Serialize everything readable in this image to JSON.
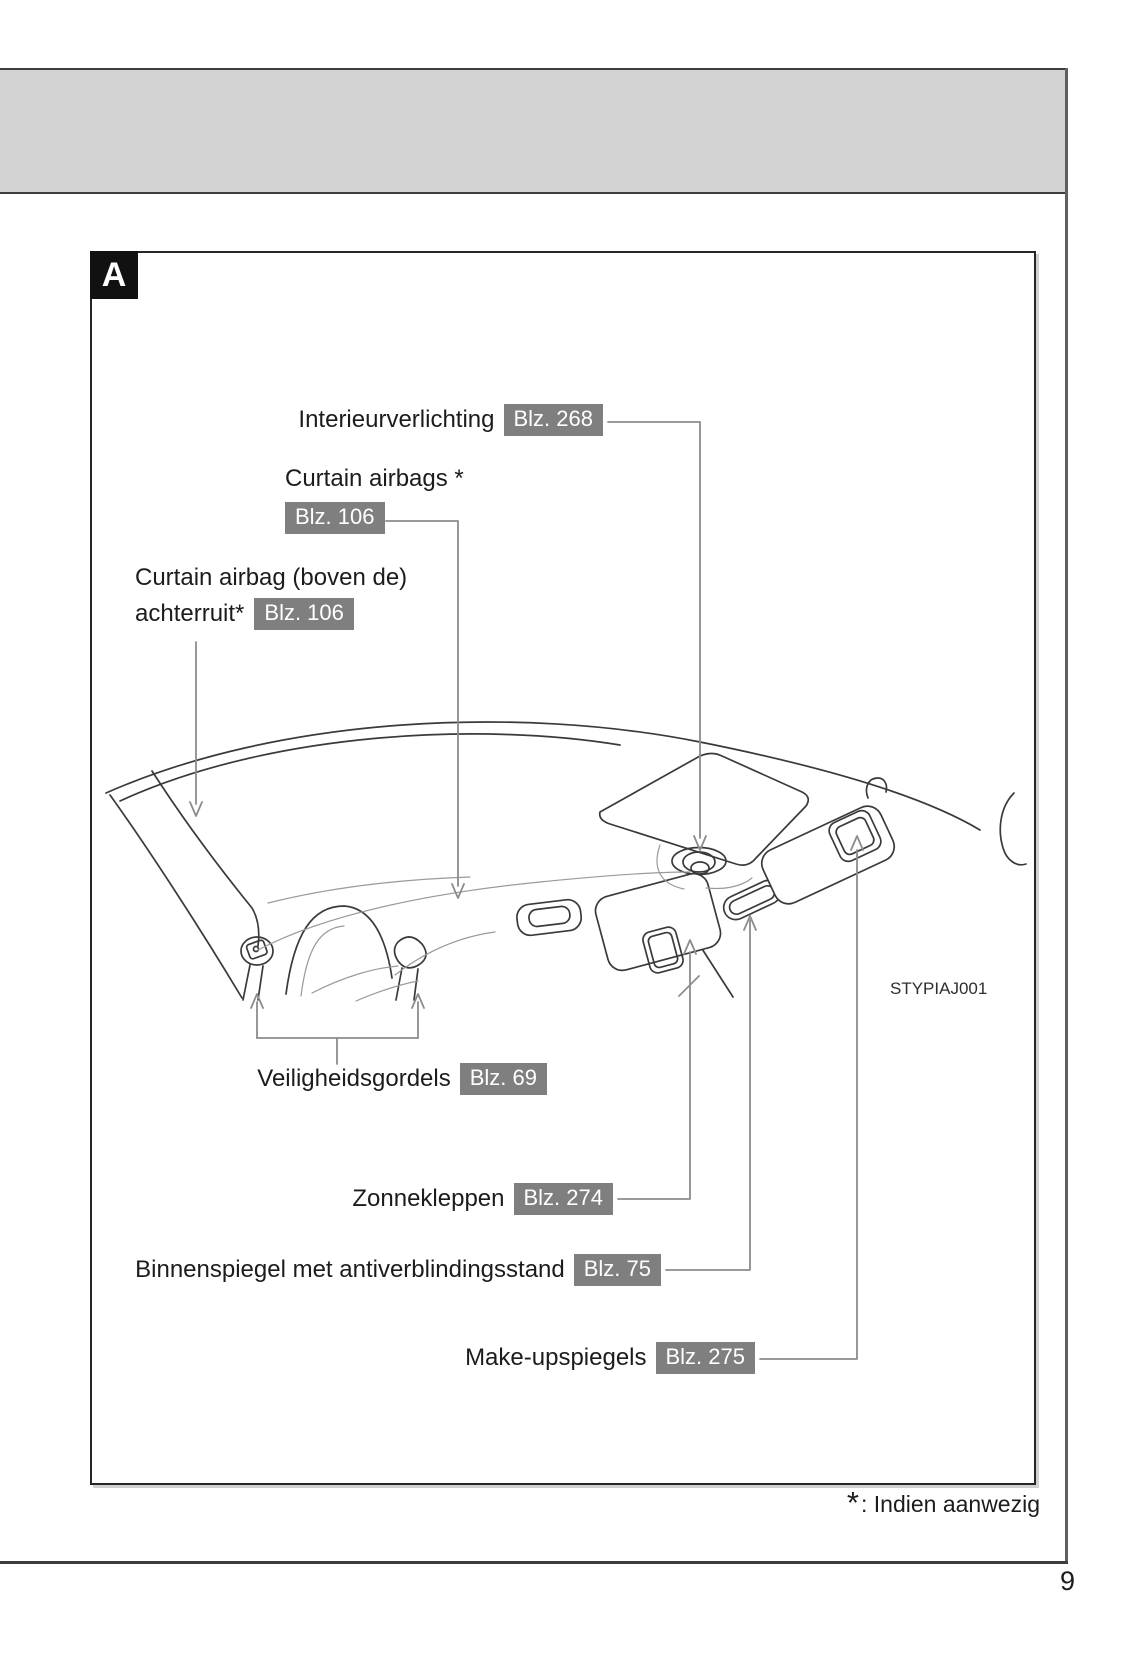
{
  "page": {
    "number": "9",
    "section_tab": "A",
    "figure_code": "STYPIAJ001"
  },
  "footnote": {
    "symbol": "*",
    "text": ": Indien aanwezig"
  },
  "callouts": {
    "interior_light": {
      "label": "Interieurverlichting",
      "page_ref": "Blz. 268"
    },
    "curtain_airbags": {
      "label": "Curtain airbags *",
      "page_ref": "Blz. 106"
    },
    "curtain_airbag_rear": {
      "label_line1": "Curtain airbag (boven de)",
      "label_line2": "achterruit*",
      "page_ref": "Blz. 106"
    },
    "seat_belts": {
      "label": "Veiligheidsgordels",
      "page_ref": "Blz. 69"
    },
    "sun_visors": {
      "label": "Zonnekleppen",
      "page_ref": "Blz. 274"
    },
    "inner_mirror": {
      "label": "Binnenspiegel met antiverblindingsstand",
      "page_ref": "Blz. 75"
    },
    "vanity_mirrors": {
      "label": "Make-upspiegels",
      "page_ref": "Blz. 275"
    }
  },
  "colors": {
    "badge_bg": "#7f7f7f",
    "badge_text": "#ffffff",
    "band_bg": "#d2d2d2",
    "drawing_line": "#3a3a3a",
    "leader_line": "#8c8c8c"
  }
}
